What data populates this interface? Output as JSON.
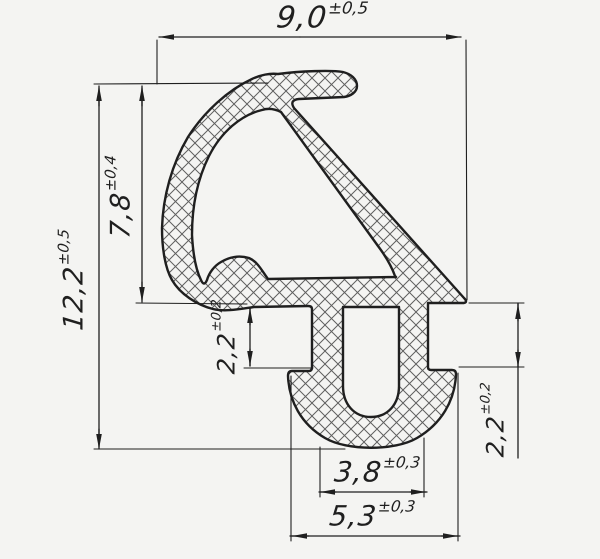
{
  "dimensions": {
    "overall_width": {
      "value": "9,0",
      "tolerance": "±0,5"
    },
    "overall_height": {
      "value": "12,2",
      "tolerance": "±0,5"
    },
    "upper_height": {
      "value": "7,8",
      "tolerance": "±0,4"
    },
    "left_notch_height": {
      "value": "2,2",
      "tolerance": "±0,2"
    },
    "right_notch_height": {
      "value": "2,2",
      "tolerance": "±0,2"
    },
    "foot_inner_width": {
      "value": "3,8",
      "tolerance": "±0,3"
    },
    "foot_outer_width": {
      "value": "5,3",
      "tolerance": "±0,3"
    }
  },
  "colors": {
    "line": "#1f1f1f",
    "hatch": "#5f5f5f",
    "paper": "#f4f4f2"
  }
}
